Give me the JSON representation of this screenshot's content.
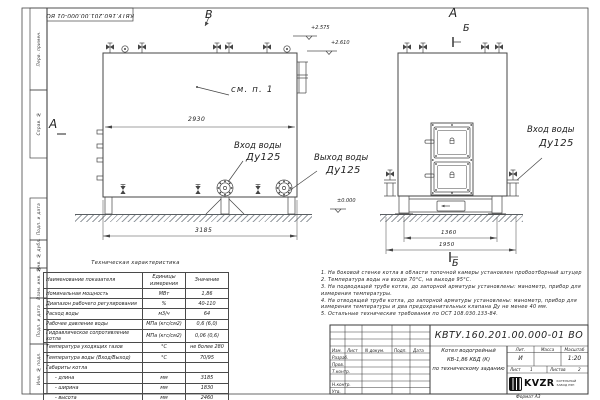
{
  "frame": {
    "corner_number": "КВТУ.160.201.00.000-01 ВО",
    "sidebar_items": [
      "Перв. примен.",
      "Справ. №",
      "Подп. и дата",
      "Инв. № дубл.",
      "Взам. инв. №",
      "Подп. и дата",
      "Инв. № подл."
    ],
    "format_note": "Формат  А3"
  },
  "side_view": {
    "view_label_top": "В",
    "view_label_left": "А",
    "dim_width": "2930",
    "dim_length": "3185",
    "callout": "см. п. 1",
    "water_inlet": "Вход воды",
    "water_inlet_dn": "Ду125",
    "water_outlet": "Выход воды",
    "water_outlet_dn": "Ду125",
    "elev_top": "+2.575",
    "elev_pipe": "+2.610",
    "elev_zero": "±0.000"
  },
  "front_view": {
    "view_label": "А",
    "section_label_top": "Б",
    "section_label_bottom": "Б",
    "water_inlet": "Вход воды",
    "water_inlet_dn": "Ду125",
    "dim_legs": "1360",
    "dim_base": "1950"
  },
  "spec_table": {
    "title": "Техническая характеристика",
    "headers": [
      "Наименование показателя",
      "Единицы измерения",
      "Значение"
    ],
    "rows": [
      [
        "Номинальная мощность",
        "МВт",
        "1,86"
      ],
      [
        "Диапазон рабочего регулирования",
        "%",
        "40-110"
      ],
      [
        "Расход воды",
        "м3/ч",
        "64"
      ],
      [
        "Рабочее давление воды",
        "МПа (кгс/см2)",
        "0,6 (6,0)"
      ],
      [
        "Гидравлическое сопротивление котла",
        "МПа (кгс/см2)",
        "0,06 (0,6)"
      ],
      [
        "Температура уходящих газов",
        "°С",
        "не более 280"
      ],
      [
        "Температура воды (Вход/Выход)",
        "°С",
        "70/95"
      ],
      [
        "Габариты котла",
        "",
        ""
      ],
      [
        "- длина",
        "мм",
        "3185"
      ],
      [
        "- ширина",
        "мм",
        "1830"
      ],
      [
        "- высота",
        "мм",
        "2460"
      ]
    ]
  },
  "notes": [
    "1.  На боковой стенке котла в области топочной камеры установлен пробоотборный штуцер",
    "2.  Температура воды на входе 70°С, на выходе 95°С.",
    "3.  На подводящей трубе котла, до запорной арматуры установлены: манометр, прибор для измерения температуры.",
    "4.  На отводящей трубе котла, до запорной арматуры установлены: манометр, прибор для измерения температуры и два предохранительных клапана Ду не менее 40 мм.",
    "5.  Остальные технические требования по ОСТ 108.030.133-84."
  ],
  "title_block": {
    "doc_number": "КВТУ.160.201.00.000-01 ВО",
    "col_izm": "Изм.",
    "col_list": "Лист",
    "col_ndoc": "N докум.",
    "col_podp": "Подп.",
    "col_data": "Дата",
    "row_razrab": "Разраб.",
    "row_prov": "Пров.",
    "row_tkontr": "Т.контр.",
    "row_nkontr": "Н.контр.",
    "row_utv": "Утв.",
    "name_line1": "Котел водогрейный",
    "name_line2": "КВ-1,86 КБД (К)",
    "name_line3": "по техническому заданию",
    "lit_label": "Лит.",
    "lit_value": "И",
    "mass_label": "Масса",
    "scale_label": "Масштаб",
    "scale_value": "1:20",
    "sheet_label": "Лист",
    "sheet_value": "1",
    "sheets_label": "Листов",
    "sheets_value": "2",
    "logo_text": "KVZR",
    "logo_sub1": "КОТЕЛЬНЫЙ",
    "logo_sub2": "ЗАВОД РЭП"
  }
}
